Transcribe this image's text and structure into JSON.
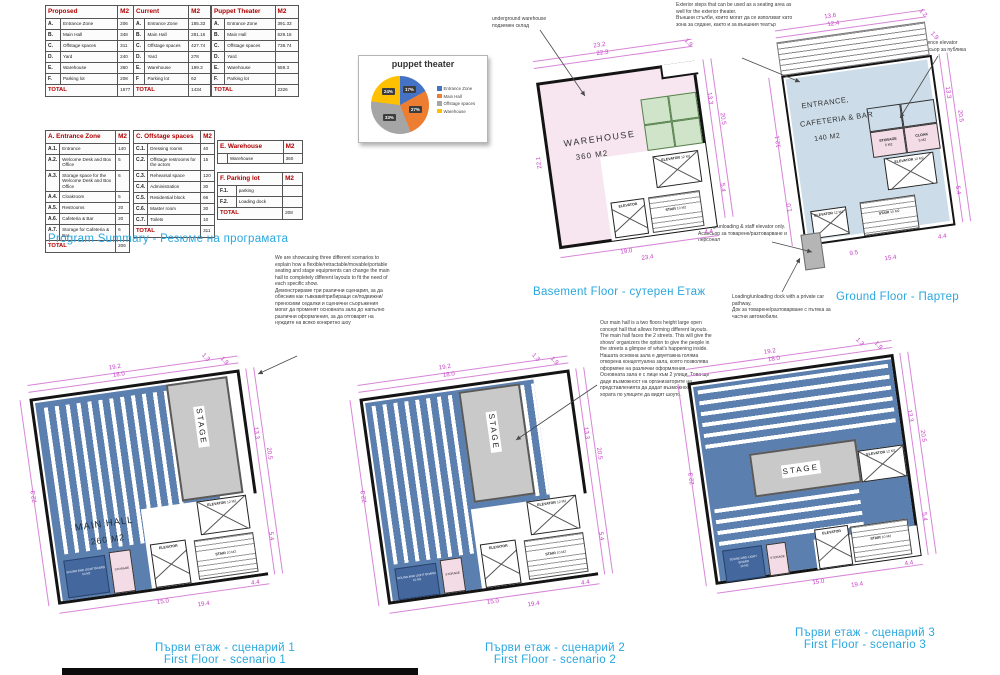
{
  "captions": {
    "program_summary": "Program Summary - Резюме на програмата",
    "basement": "Basement Floor - сутерен Етаж",
    "ground": "Ground Floor - Партер",
    "s1_bg": "Първи етаж - сценарий 1",
    "s1_en": "First Floor - scenario 1",
    "s2_bg": "Първи етаж - сценарий 2",
    "s2_en": "First Floor - scenario 2",
    "s3_bg": "Първи етаж - сценарий 3",
    "s3_en": "First Floor - scenario 3"
  },
  "tables": {
    "proposed": {
      "title": "Proposed",
      "unit": "M2",
      "rows": [
        [
          "A.",
          "Entrance Zone",
          "206"
        ],
        [
          "B.",
          "Main Hall",
          "348"
        ],
        [
          "C.",
          "Offstage spaces",
          "311"
        ],
        [
          "D.",
          "Yard",
          "240"
        ],
        [
          "E.",
          "Warehouse",
          "360"
        ],
        [
          "F.",
          "Parking lot",
          "208"
        ]
      ],
      "total_label": "TOTAL",
      "total": "1677"
    },
    "current": {
      "title": "Current",
      "unit": "M2",
      "rows": [
        [
          "A.",
          "Entrance Zone",
          "185.33"
        ],
        [
          "B.",
          "Main Hall",
          "281.16"
        ],
        [
          "C.",
          "Offstage spaces",
          "427.74"
        ],
        [
          "D.",
          "Yard",
          "278"
        ],
        [
          "E.",
          "Warehouse",
          "199.3"
        ],
        [
          "F",
          "Parking lot",
          "62"
        ]
      ],
      "total_label": "TOTAL",
      "total": "1434"
    },
    "puppet": {
      "title": "Puppet Theater",
      "unit": "M2",
      "rows": [
        [
          "A.",
          "Entrance Zone",
          "391.33"
        ],
        [
          "B.",
          "Main Hall",
          "629.16"
        ],
        [
          "C.",
          "Offstage spaces",
          "738.74"
        ],
        [
          "D.",
          "Yard",
          ""
        ],
        [
          "E.",
          "Warehouse",
          "559.3"
        ],
        [
          "F.",
          "Parking lot",
          ""
        ]
      ],
      "total_label": "TOTAL",
      "total": "2326"
    },
    "entrance": {
      "title": "A. Entrance Zone",
      "unit": "M2",
      "rows": [
        [
          "A.1.",
          "Entrance",
          "140"
        ],
        [
          "A.2.",
          "Welcome Desk and Box Office",
          "5"
        ],
        [
          "A.3.",
          "Storage space for the Welcome Desk and Box Office",
          "6"
        ],
        [
          "A.4.",
          "Cloakroom",
          "5"
        ],
        [
          "A.5.",
          "Restrooms",
          "20"
        ],
        [
          "A.6.",
          "Cafeteria & Bar",
          "20"
        ],
        [
          "A.7.",
          "Storage for Cafeteria & Bar",
          "6"
        ]
      ],
      "total_label": "TOTAL",
      "total": "206"
    },
    "offstage": {
      "title": "C. Offstage spaces",
      "unit": "M2",
      "rows": [
        [
          "C.1.",
          "Dressing rooms",
          "40"
        ],
        [
          "C.2.",
          "Offstage restrooms for the actors",
          "15"
        ],
        [
          "C.3.",
          "Rehearsal space",
          "120"
        ],
        [
          "C.4.",
          "Administration",
          "30"
        ],
        [
          "C.5.",
          "Residential block",
          "66"
        ],
        [
          "C.6.",
          "Master room",
          "30"
        ],
        [
          "C.7.",
          "Toilets",
          "10"
        ]
      ],
      "total_label": "TOTAL",
      "total": "311"
    },
    "warehouse": {
      "title": "E. Warehouse",
      "unit": "M2",
      "rows": [
        [
          "",
          "Warehouse",
          "360"
        ]
      ]
    },
    "parking": {
      "title": "F. Parking lot",
      "unit": "M2",
      "rows": [
        [
          "F.1.",
          "parking",
          ""
        ],
        [
          "F.2.",
          "Loading dock",
          ""
        ]
      ],
      "total_label": "TOTAL",
      "total": "208"
    }
  },
  "chart_data": {
    "type": "pie",
    "title": "puppet theater",
    "labels": [
      "Entrance Zone",
      "Main Hall",
      "Offstage spaces",
      "Warehouse"
    ],
    "values": [
      17,
      27,
      33,
      24
    ],
    "value_labels": [
      "17%",
      "27%",
      "33%",
      "24%"
    ],
    "colors": [
      "#4472C4",
      "#ED7D31",
      "#A5A5A5",
      "#FFC000"
    ],
    "legend_position": "right"
  },
  "annotations": {
    "underground": "underground warehouse\nподземен склад",
    "exterior_steps": "Exterior steps that can be used as a seating area as well for the exterior theater.\nВъншни стълби, които могат да се използват като зона за сядане, както и за външния театър",
    "audience_elevator": "audience elevator\nасансьор за публика",
    "staff_elevator": "Loading/unloading & staff elevator only.\nАсансьор за товарене/разтоварване и персонал",
    "loading_dock": "Loading/unloading dock with a private car pathway.\nДок за товарене/разтоварване с пътека за частни автомобили.",
    "scenarios_intro": "We are showcasing three different scenarios to explain how a flexible/retractable/movable/portable seating and stage equipments can change the main hall to completely different layouts to fit the need of each specific show.\nДемонстрираме три различни сценария, за да обясним как гъвкави/прибиращи се/подвижни/преносими седалки и сценични съоръжения могат да променят основната зала до напълно различни оформления, за да отговарят на нуждите на всяко конкретно шоу",
    "main_hall_note": "Our main hall is a two floors height large open concept hall that allows forming different layouts.\nThe main hall faces the 2 streets. This will give the shows' organizers the option to give the people in the streets a glimpse of what's happening inside.\nНашата основна зала е двуетажна голяма отворена концептуална зала, която позволява оформяне на различни оформления\nОсновната зала е с лице към 2 улици. Това ще даде възможност на организаторите на представленията да дадат възможност на хората по улиците да видят шоуто."
  },
  "plans": {
    "basement": {
      "room": "WAREHOUSE",
      "area": "360 M2",
      "elevator": "ELEVATOR",
      "elevator_area": "12 M2",
      "stair": "STAIR",
      "stair_area": "10 M2",
      "dims": {
        "top_outer": "23.2",
        "top_inner": "22.3",
        "notch": "1.9",
        "right_upper": "13.3",
        "right_outer": "20.5",
        "right_lower": "5.4",
        "corner": "4.4",
        "bottom_a": "19.0",
        "bottom_b": "23.4",
        "left": "22.1"
      }
    },
    "ground": {
      "line1": "ENTRANCE,",
      "line2": "CAFETERIA & BAR",
      "area": "140 M2",
      "storage": "STORAGE",
      "storage_area": "5 M2",
      "cloak": "CLOAK",
      "cloak_area": "5 M2",
      "elevator": "ELEVATOR",
      "elevator_area": "12 M2",
      "stair": "STAIR",
      "stair_area": "10 M2",
      "dims": {
        "top_outer": "13.6",
        "top_inner": "12.4",
        "notch": "1.2",
        "right_upper": "1.9",
        "right_mid": "13.3",
        "right_outer": "20.5",
        "left": "12.1",
        "left_lower": "1.0",
        "right_lower": "5.4",
        "corner": "4.4",
        "bottom_a": "9.5",
        "bottom_b": "15.4"
      }
    },
    "s1": {
      "hall": "MAIN HALL",
      "hall_area": "260 M2",
      "stage": "STAGE",
      "elevator": "ELEVATOR",
      "elevator_area": "12 M2",
      "stair": "STAIR",
      "stair_area": "10 M2",
      "storage": "STORAGE",
      "board": "SOUND AND LIGHT BOARD",
      "board_area": "10 M2",
      "dims": {
        "top_outer": "19.2",
        "top_inner": "18.0",
        "notch_a": "1.3",
        "notch_b": "1.9",
        "left": "22.3",
        "right_upper": "13.3",
        "right_outer": "20.5",
        "right_lower": "5.4",
        "corner": "4.4",
        "bottom_a": "15.0",
        "bottom_b": "19.4"
      }
    },
    "s2": {
      "stage": "STAGE",
      "elevator": "ELEVATOR",
      "elevator_area": "12 M2",
      "stair": "STAIR",
      "stair_area": "10 M2",
      "storage": "STORAGE",
      "board": "SOUND AND LIGHT BOARD",
      "board_area": "10 M2",
      "dims": {
        "top_outer": "19.2",
        "top_inner": "18.0",
        "notch_a": "1.3",
        "notch_b": "1.9",
        "left": "22.3",
        "right_upper": "13.3",
        "right_outer": "20.5",
        "right_lower": "5.4",
        "corner": "4.4",
        "bottom_a": "15.0",
        "bottom_b": "19.4"
      }
    },
    "s3": {
      "stage": "STAGE",
      "elevator": "ELEVATOR",
      "elevator_area": "12 M2",
      "stair": "STAIR",
      "stair_area": "10 M2",
      "storage": "STORAGE",
      "board": "SOUND AND LIGHT BOARD",
      "board_area": "10 M2",
      "dims": {
        "top_outer": "19.2",
        "top_inner": "18.0",
        "notch_a": "1.3",
        "notch_b": "1.9",
        "left": "22.3",
        "right_upper": "13.3",
        "right_outer": "20.5",
        "right_lower": "5.4",
        "corner": "4.4",
        "bottom_a": "15.0",
        "bottom_b": "19.4"
      }
    }
  }
}
